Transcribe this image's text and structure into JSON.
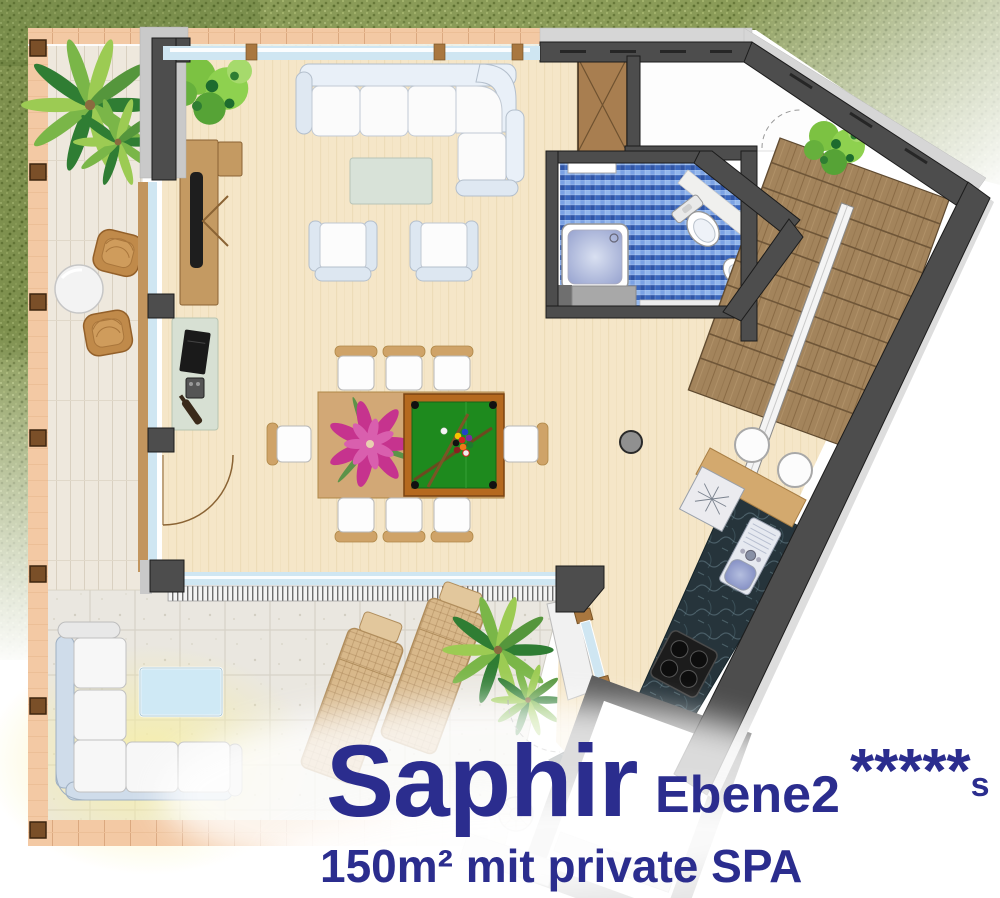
{
  "title": {
    "name": "Saphir",
    "level": "Ebene2",
    "stars": "*****",
    "stars_suffix": "s",
    "subtitle": "150m² mit private SPA"
  },
  "palette": {
    "text_navy": "#2b2d8e",
    "grass_green": "#8a9b58",
    "floor_beige": "#f5e6c8",
    "mosaic_blue": "#4d7ed0",
    "pool_felt_green": "#1e8a1e",
    "stair_wood": "#a3845c",
    "counter_granite": "#26343b",
    "wall_gray": "#4d4d4d",
    "terrace_peach": "#f3c9a4",
    "window_glass": "#cfe6f2"
  }
}
